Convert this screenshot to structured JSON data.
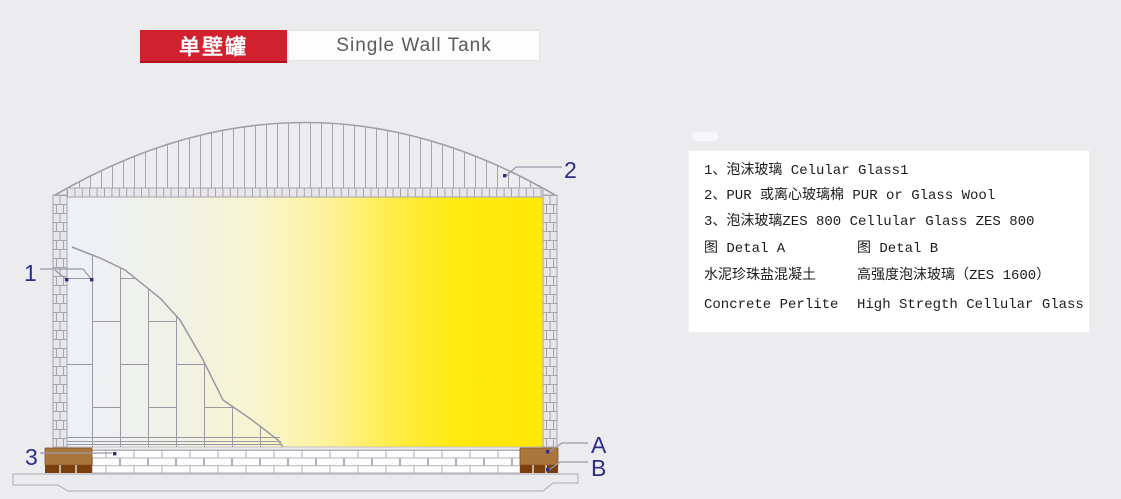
{
  "header": {
    "title_cn": "单壁罐",
    "title_en": "Single Wall Tank"
  },
  "legend": {
    "items": [
      "1、泡沫玻璃 Celular Glass1",
      "2、PUR 或离心玻璃棉 PUR or Glass Wool",
      "3、泡沫玻璃ZES 800 Cellular Glass ZES 800"
    ],
    "detail_a": {
      "title": "图 Detal A",
      "line_cn": "水泥珍珠盐混凝土",
      "line_en": "Concrete Perlite"
    },
    "detail_b": {
      "title": "图 Detal B",
      "line_cn": "高强度泡沫玻璃（ZES 1600）",
      "line_en": "High Stregth Cellular Glass"
    }
  },
  "diagram": {
    "callouts": {
      "c1": "1",
      "c2": "2",
      "c3": "3",
      "cA": "A",
      "cB": "B"
    },
    "colors": {
      "accent_red": "#d2212e",
      "callout_navy": "#2d2d8c",
      "tank_yellow": "#ffe805",
      "detail_brown": "#a9763c",
      "detail_dark_brown": "#7c3f10",
      "line_gray": "#a8a4ac"
    }
  }
}
